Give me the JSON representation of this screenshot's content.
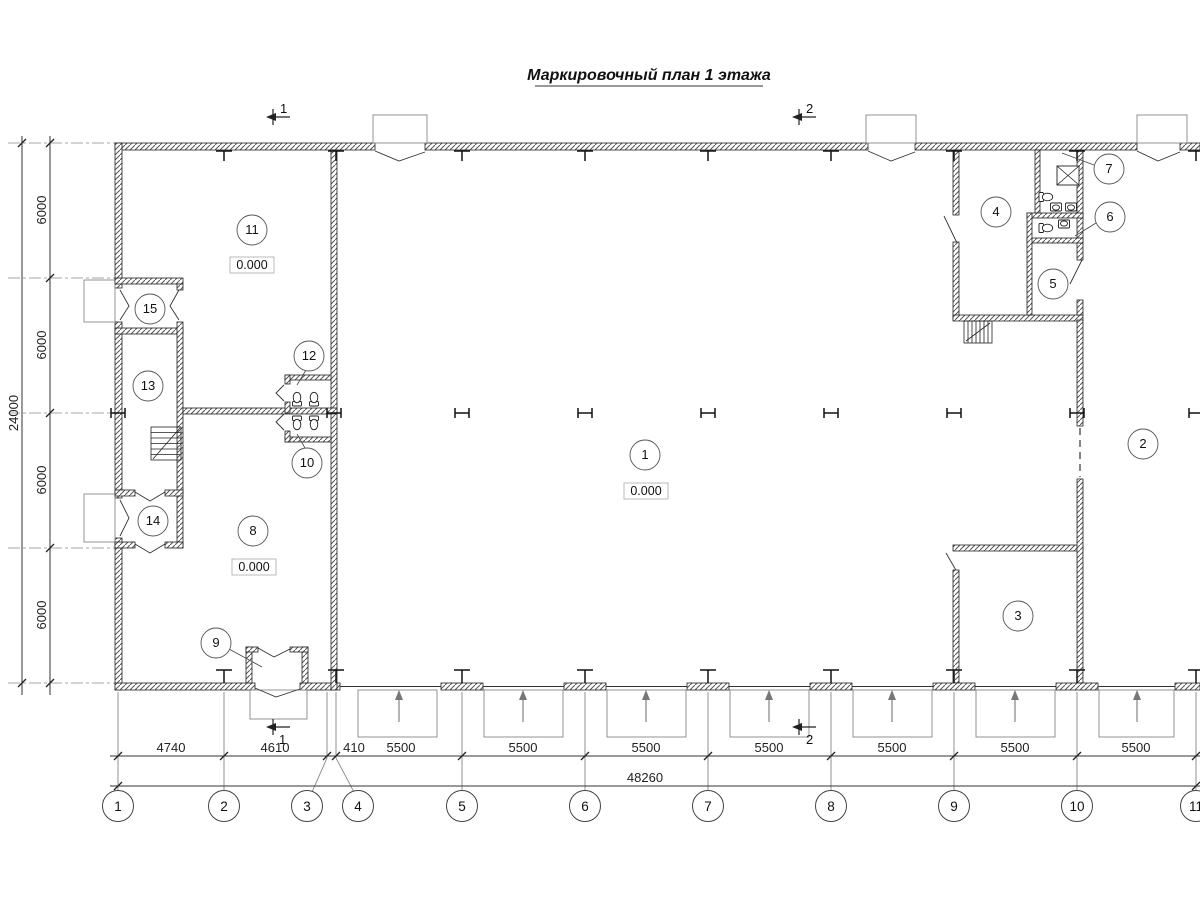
{
  "title": "Маркировочный план 1 этажа",
  "rooms": [
    "1",
    "2",
    "3",
    "4",
    "5",
    "6",
    "7",
    "8",
    "9",
    "10",
    "11",
    "12",
    "13",
    "14",
    "15"
  ],
  "elevation": "0.000",
  "sections": {
    "s1": "1",
    "s2": "2"
  },
  "dims": {
    "bottom": [
      "4740",
      "4610",
      "410",
      "5500",
      "5500",
      "5500",
      "5500",
      "5500",
      "5500",
      "5500"
    ],
    "bottom_total": "48260",
    "left": [
      "6000",
      "6000",
      "6000",
      "6000"
    ],
    "left_total": "24000"
  },
  "grid_bubbles": [
    "1",
    "2",
    "3",
    "4",
    "5",
    "6",
    "7",
    "8",
    "9",
    "10",
    "11"
  ],
  "colors": {
    "line": "#222222",
    "dim_line": "#333333",
    "axis": "#888888",
    "background": "#ffffff"
  }
}
